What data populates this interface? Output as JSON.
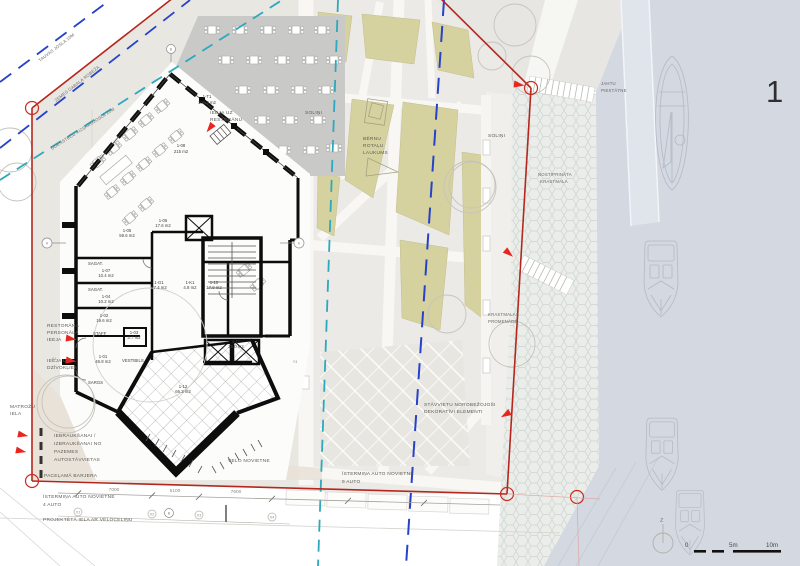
{
  "sheet": {
    "number": "1"
  },
  "zones": {
    "tauvas_josla": "TAUVAS JOSLA 10M",
    "zemes_robeza": "ZEMES GABALA ROBEŽA",
    "aizsargjosla": "ŪDENSTEČU AIZSARGJOSLA 20M"
  },
  "site": {
    "solini_left": "SOLIŅI",
    "solini_right": "SOLIŅI",
    "bernu_1": "BĒRNU",
    "bernu_2": "ROTAĻU",
    "bernu_3": "LAUKUMS",
    "nostiprinata_1": "NOSTIPRINĀTA",
    "nostiprinata_2": "KRASTMALA",
    "jahtu_1": "JAHTU",
    "jahtu_2": "PIESTĀTNE",
    "krastmalas_1": "KRASTMALAS",
    "krastmalas_2": "PROMENĀDE",
    "stavvietu_1": "STĀVVIETU NOROBEŽOJOŠI",
    "stavvietu_2": "DEKORATĪVI ELEMENTI",
    "istermina9_1": "ĪSTERMIŅA AUTO NOVIETNE",
    "istermina9_2": "9 AUTO",
    "istermina4_1": "ĪSTERMIŅA AUTO NOVIETNE",
    "istermina4_2": "4 AUTO",
    "velo": "VELO NOVIETNE",
    "projekteta": "PROJEKTĒTĀ IELA AR VELOCELIŅU",
    "matrozu_1": "MATROŽU",
    "matrozu_2": "IELA",
    "barjera": "PACEĻAMĀ BARJERA",
    "iebrauk_1": "IEBRAUKŠANAI /",
    "iebrauk_2": "IZBRAUKŠANAI NO",
    "iebrauk_3": "PAZEMES",
    "iebrauk_4": "AUTOSTĀVVIETAS",
    "personala_1": "RESTORĀNA",
    "personala_2": "PERSONĀLA",
    "personala_3": "IEEJA",
    "dzivokliem_1": "IEEJA UZ",
    "dzivokliem_2": "DZĪVOKĻIEM",
    "ieeja_rest_1": "IEEJA UZ",
    "ieeja_rest_2": "RESTORĀNU"
  },
  "rooms": {
    "terase_id": "1-T1",
    "terase_area": "109.2 m2",
    "rest_id": "1-08",
    "rest_area": "215 m2",
    "r01_id": "1-01",
    "r01_area": "46.8 m2",
    "r02_id": "1-02",
    "r02_area": "19.6 m2",
    "r03_id": "1-03",
    "r03_area": "3.7 m2",
    "r04_id": "1-04",
    "r04_area": "10.2 m2",
    "r05_id": "1-05",
    "r05_area": "59.6 m2",
    "r06_id": "1-06",
    "r06_area": "17.6 m2",
    "r07_id": "1-07",
    "r07_area": "10.4 m2",
    "rg1_id": "1-G1",
    "rg1_area": "27.4 m2",
    "rk1_id": "1-K1",
    "rk1_area": "4.8 m2",
    "r10_id": "1-10",
    "r10_area": "17.9 m2",
    "r11_id": "1-11",
    "r11_area": "25.0 m2",
    "r12_id": "1-12",
    "r12_area": "66.3 m2",
    "staff": "STAFF",
    "vestibils": "VESTIBILS",
    "sargs": "SARGS",
    "sagat1": "SAGAT.",
    "sagat2": "SAGAT."
  },
  "dimensions": {
    "d1": "7000",
    "d2": "5100",
    "d3": "7600"
  },
  "grid": {
    "a_left": "A",
    "a_right": "A",
    "b_top": "B",
    "b_bottom": "B",
    "x1": "X1",
    "x2": "X2",
    "x3": "X3",
    "x4": "X4",
    "y1": "Y1",
    "y3": "Y3"
  },
  "scalebar": {
    "zero": "0",
    "five": "5m",
    "ten": "10m"
  },
  "north": {
    "label": "Z"
  },
  "colors": {
    "boundary_red": "#b5271e",
    "setback_navy": "#2742c8",
    "protect_teal": "#2ea8bc",
    "khaki": "#d6d2a0",
    "water": "#d3d8e1",
    "arrow_red": "#e8251f"
  }
}
